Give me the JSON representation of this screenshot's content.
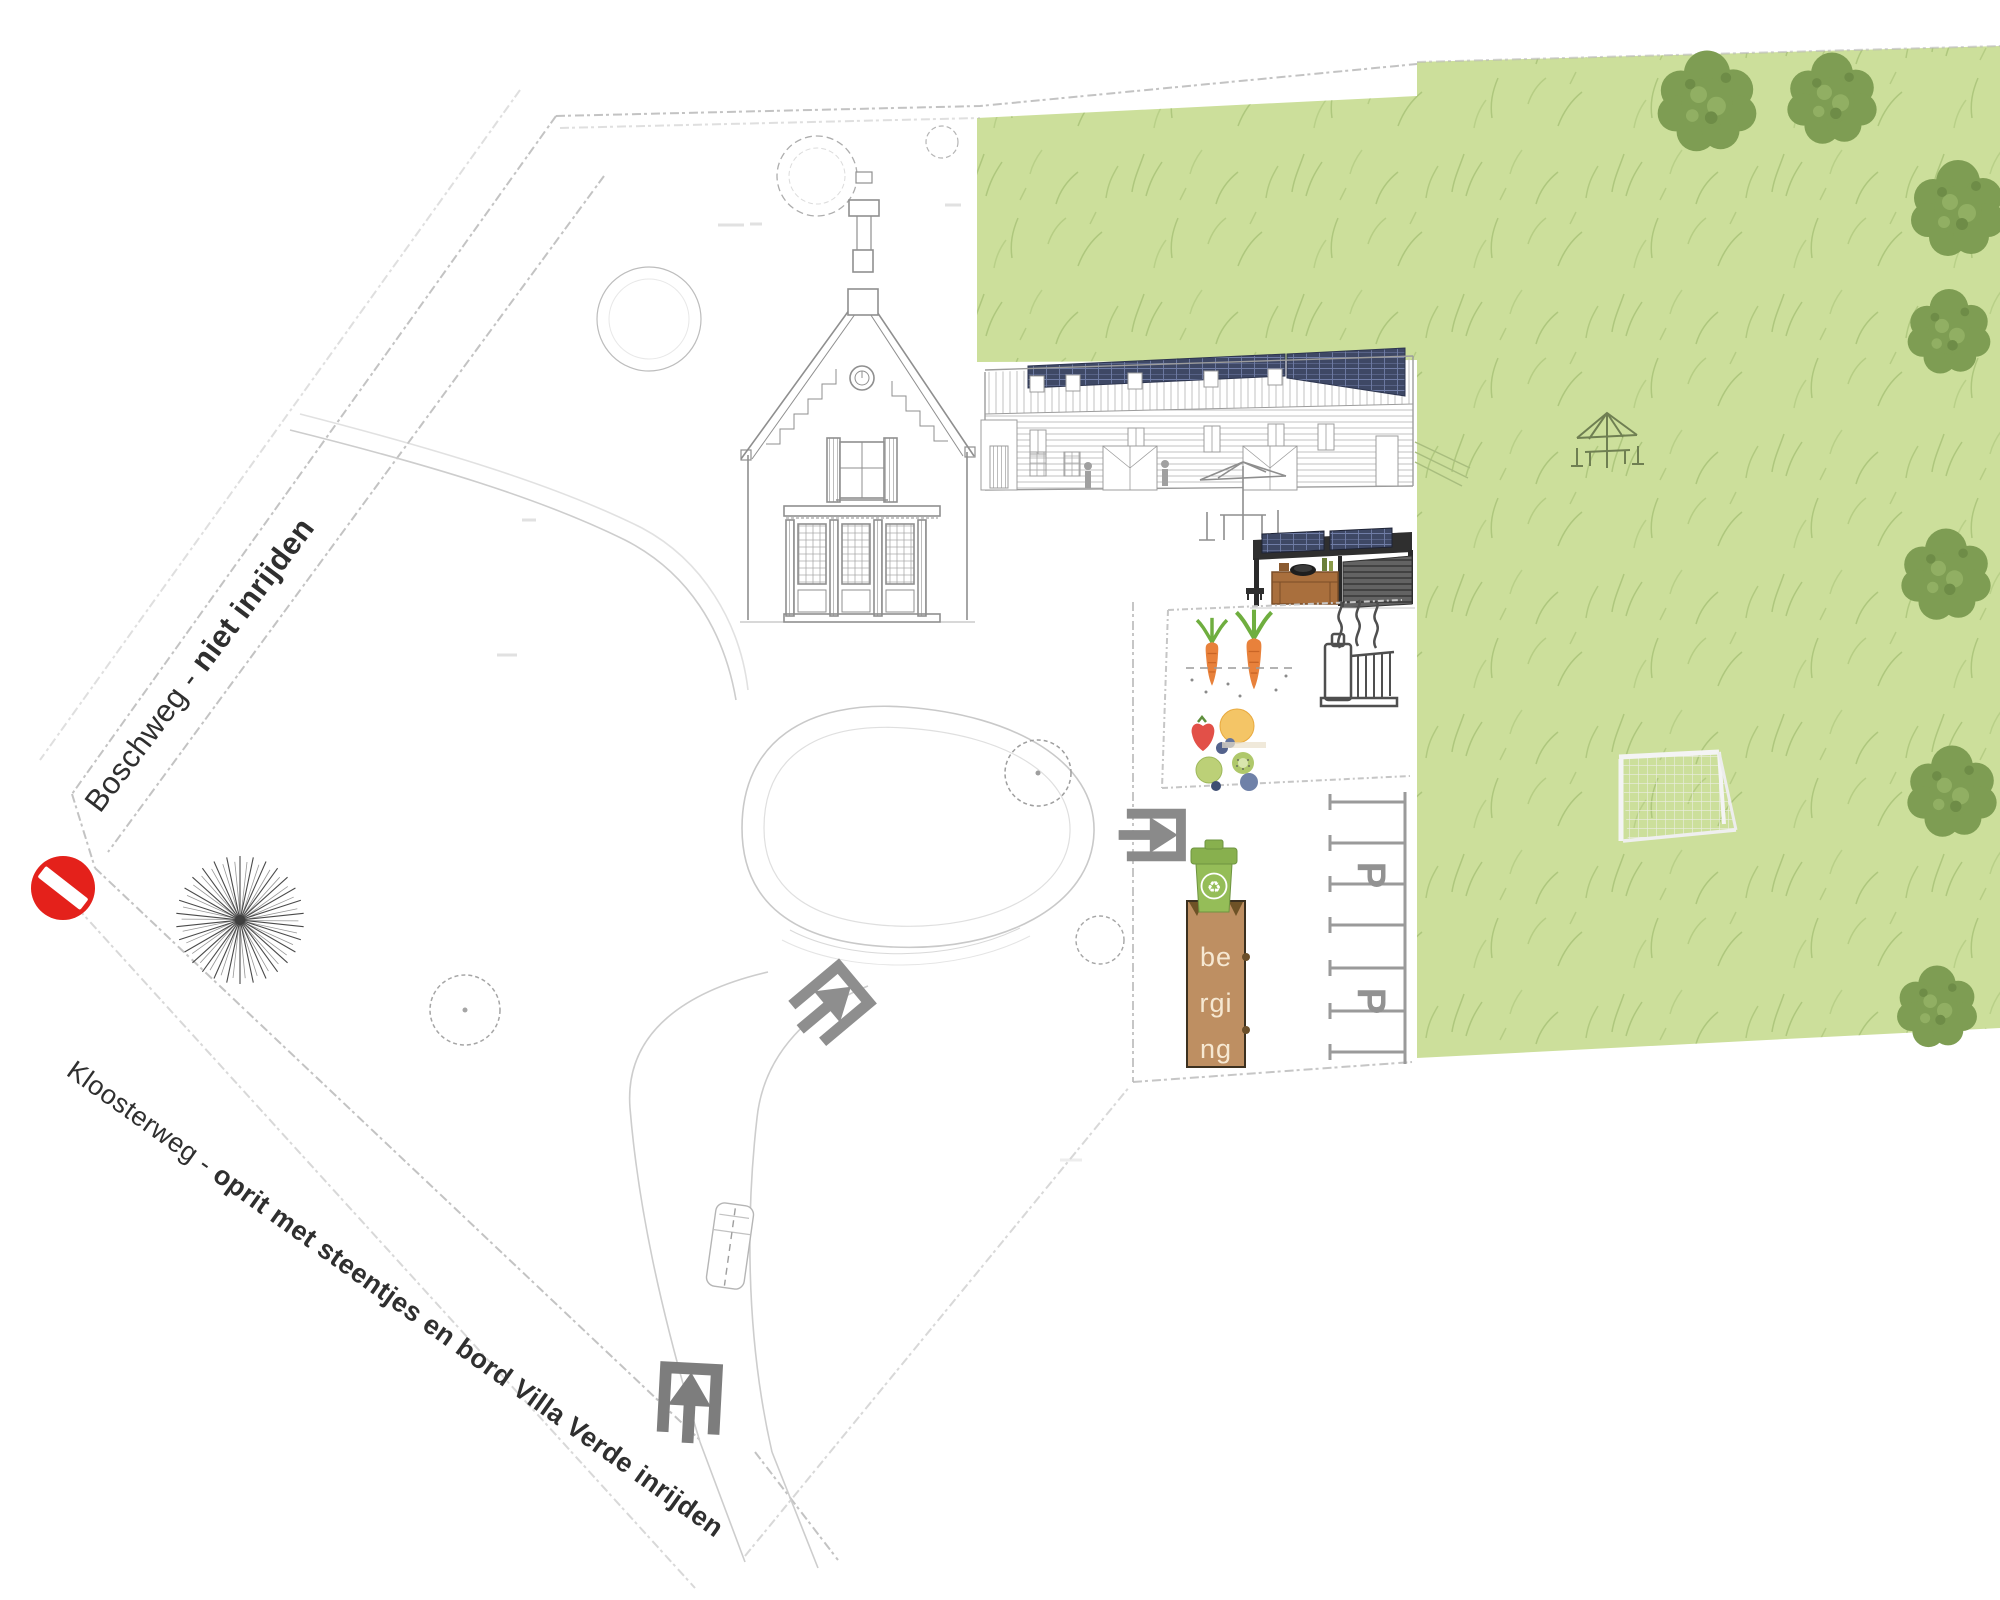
{
  "roads": {
    "boschweg": {
      "name": "Boschweg",
      "separator": " - ",
      "instruction": "niet inrijden"
    },
    "kloosterweg": {
      "name": "Kloosterweg",
      "separator": " - ",
      "instruction": "oprit met steentjes en bord Villa Verde inrijden"
    }
  },
  "storage": {
    "label": "berging",
    "display_lines": [
      "be",
      "rgi",
      "ng"
    ]
  },
  "parking": {
    "stall_letter": "P",
    "stall_count": 6
  },
  "icons": {
    "no_entry": "red circle with white bar",
    "entrance_arrow": "gray arrow entering open bracket",
    "recycle_glyph": "♻",
    "waste_bin": "green wheelie bin",
    "storage_shed": "brown shed",
    "soccer_goal": "white goal with net",
    "parasol_table": "parasol with table and chairs",
    "vegetable_garden": "carrots and fruits",
    "heater": "radiator with steam",
    "solar_panels": "dark panel strips on roofs",
    "sunburst_tree": "radiating line tree symbol",
    "van": "sketched van on driveway"
  },
  "colors": {
    "field_green": "#CCDF9B",
    "grass_stroke": "#A6C175",
    "tree_green": "#7E9D53",
    "tree_green_light": "#91AF63",
    "storage_brown": "#BE8F62",
    "storage_text": "#F6E8D2",
    "bin_green": "#95BD58",
    "bin_lid_green": "#88B04E",
    "no_entry_red": "#E4211B",
    "arrow_gray": "#8A8A8A",
    "plan_line_gray": "#9A9A9A",
    "label_text": "#2F2F2F",
    "solar_panel": "#3E4865",
    "parking_letter_gray": "#929292",
    "carrot_orange": "#E8813B"
  }
}
